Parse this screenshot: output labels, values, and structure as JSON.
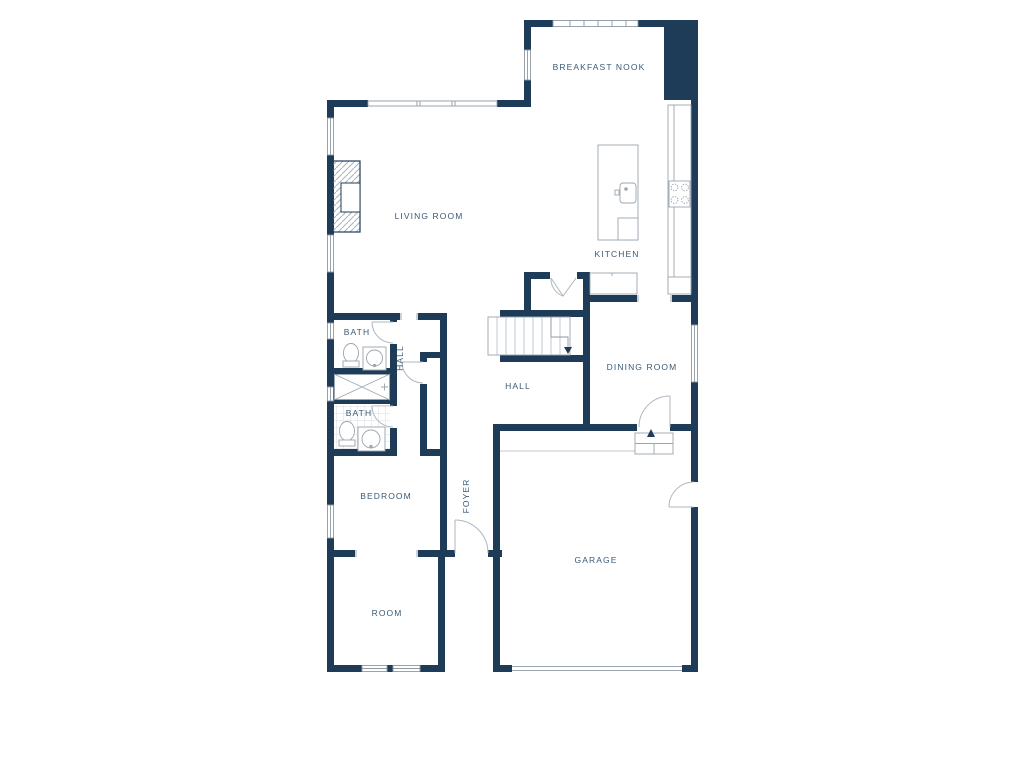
{
  "plan": {
    "title": "Single-story residential floor plan",
    "colors": {
      "wall": "#1e3c57",
      "fixture_line": "#9aa5ae",
      "door_arc": "#aeb7bf",
      "tile_line": "#ccd3d8",
      "hatch_line": "#a9b4bd",
      "label_text": "#3a5a74",
      "background": "#ffffff"
    },
    "rooms": [
      {
        "id": "breakfast-nook",
        "label": "BREAKFAST NOOK",
        "orientation": "horizontal"
      },
      {
        "id": "living-room",
        "label": "LIVING ROOM",
        "orientation": "horizontal"
      },
      {
        "id": "kitchen",
        "label": "KITCHEN",
        "orientation": "horizontal"
      },
      {
        "id": "dining-room",
        "label": "DINING ROOM",
        "orientation": "horizontal"
      },
      {
        "id": "hall",
        "label": "HALL",
        "orientation": "horizontal"
      },
      {
        "id": "hall-upper",
        "label": "HALL",
        "orientation": "vertical"
      },
      {
        "id": "bath-1",
        "label": "BATH",
        "orientation": "horizontal"
      },
      {
        "id": "bath-2",
        "label": "BATH",
        "orientation": "horizontal"
      },
      {
        "id": "bedroom",
        "label": "BEDROOM",
        "orientation": "horizontal"
      },
      {
        "id": "foyer",
        "label": "FOYER",
        "orientation": "vertical"
      },
      {
        "id": "garage",
        "label": "GARAGE",
        "orientation": "horizontal"
      },
      {
        "id": "room",
        "label": "ROOM",
        "orientation": "horizontal"
      }
    ],
    "fixtures": [
      "fireplace",
      "kitchen-island",
      "island-sink",
      "dishwasher",
      "wall-counter",
      "cooktop",
      "buffet-counter",
      "stairs",
      "closet-bifold-door",
      "toilet",
      "vanity-sink",
      "shower",
      "tiled-floor",
      "entry-steps",
      "garage-door",
      "front-door"
    ]
  }
}
